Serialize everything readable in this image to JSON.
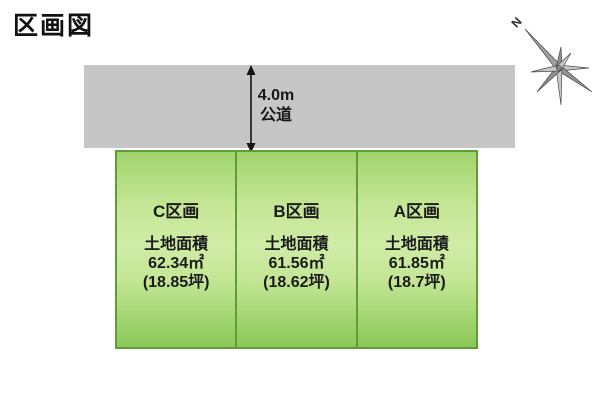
{
  "page": {
    "title": "区画図"
  },
  "compass": {
    "north_label": "N"
  },
  "road": {
    "width_label": "4.0m",
    "type_label": "公道"
  },
  "plots": [
    {
      "name": "C区画",
      "area_label": "土地面積",
      "area_sqm": "62.34㎡",
      "area_tsubo": "(18.85坪)"
    },
    {
      "name": "B区画",
      "area_label": "土地面積",
      "area_sqm": "61.56㎡",
      "area_tsubo": "(18.62坪)"
    },
    {
      "name": "A区画",
      "area_label": "土地面積",
      "area_sqm": "61.85㎡",
      "area_tsubo": "(18.7坪)"
    }
  ],
  "colors": {
    "plot_fill_light": "#cfeca6",
    "plot_fill_dark": "#8cc758",
    "plot_border": "#5f9e35",
    "road_fill": "#c6c6c6",
    "text": "#1b1b1b"
  }
}
